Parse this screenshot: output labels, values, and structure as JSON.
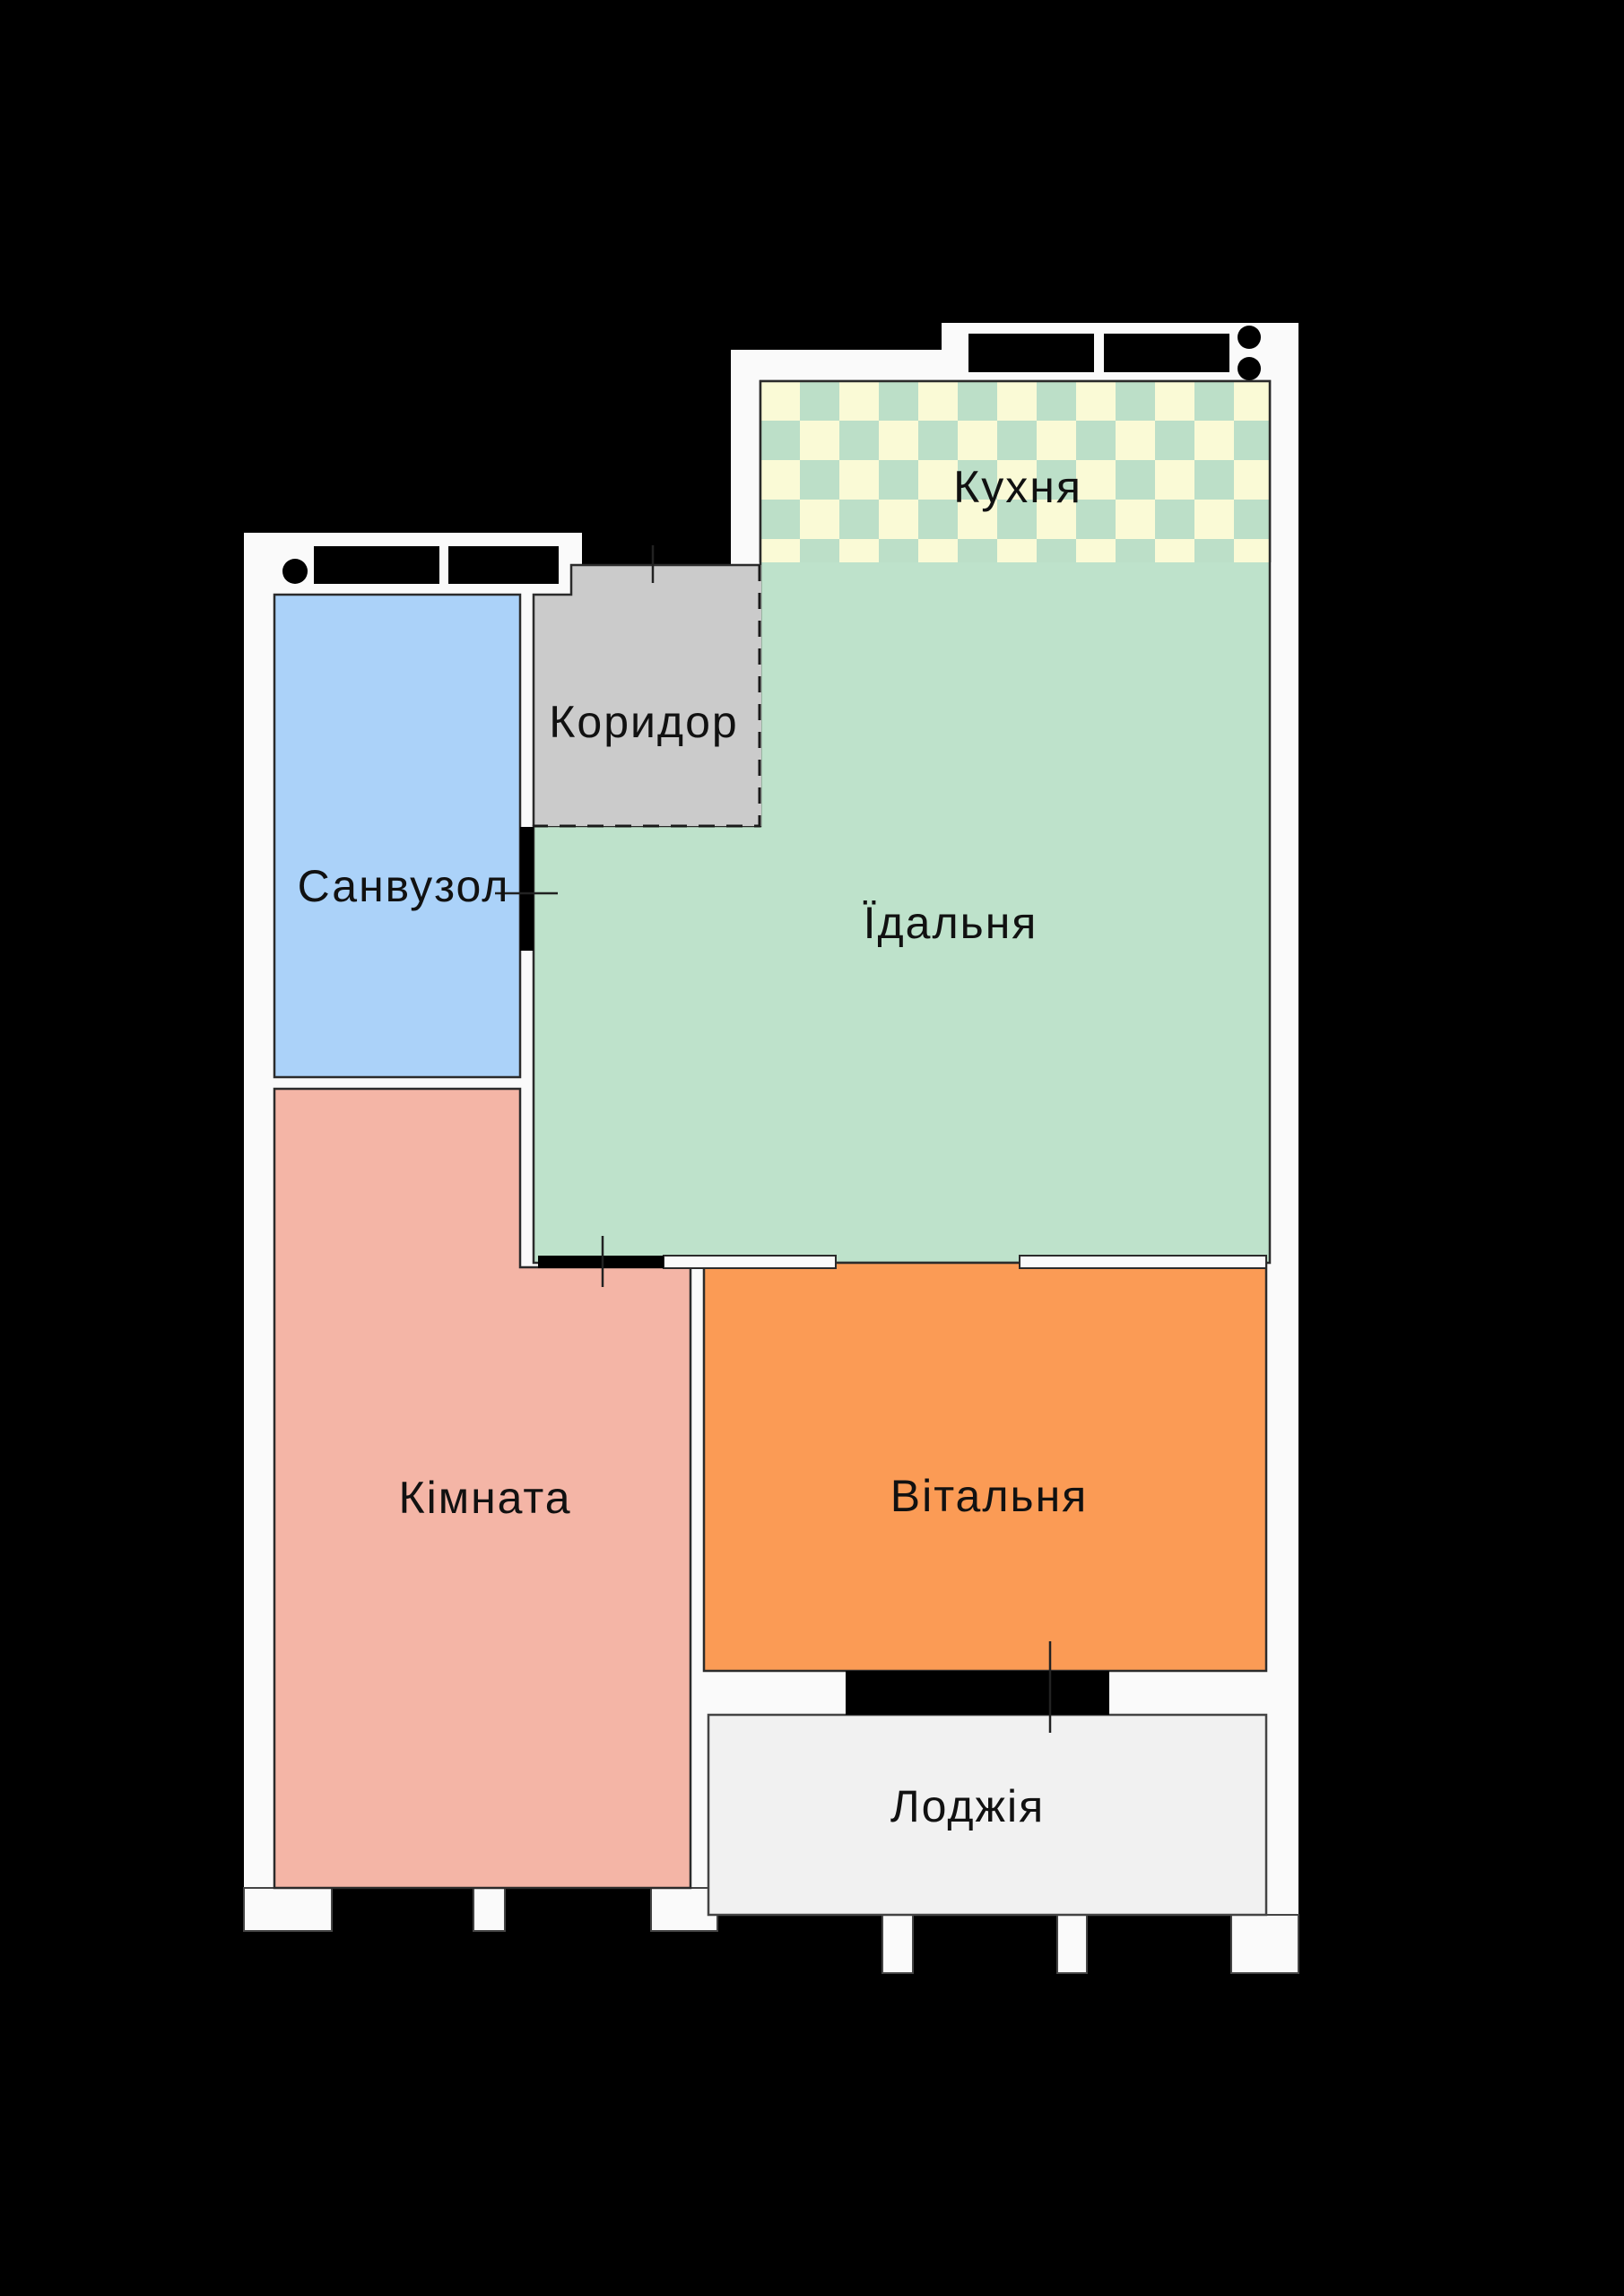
{
  "plan": {
    "background_color": "#000000",
    "wall_color": "#fafafa",
    "outline_color": "#2b2b2b",
    "window_symbol_color": "#000000",
    "label_color": "#111111",
    "rooms": {
      "kitchen": {
        "label": "Кухня",
        "color": "#bee2cb",
        "checker_light": "#fafad6",
        "checker_dark": "#bcdfc8"
      },
      "corridor": {
        "label": "Коридор",
        "color": "#cbcbcb"
      },
      "bathroom": {
        "label": "Санвузол",
        "color": "#abd2f9"
      },
      "bedroom": {
        "label": "Кімната",
        "color": "#f4b5a6"
      },
      "dining": {
        "label": "Їдальня",
        "color": "#bee2cb"
      },
      "living": {
        "label": "Вітальня",
        "color": "#fb9b55"
      },
      "loggia": {
        "label": "Лоджія",
        "color": "#f1f1f1"
      }
    }
  }
}
